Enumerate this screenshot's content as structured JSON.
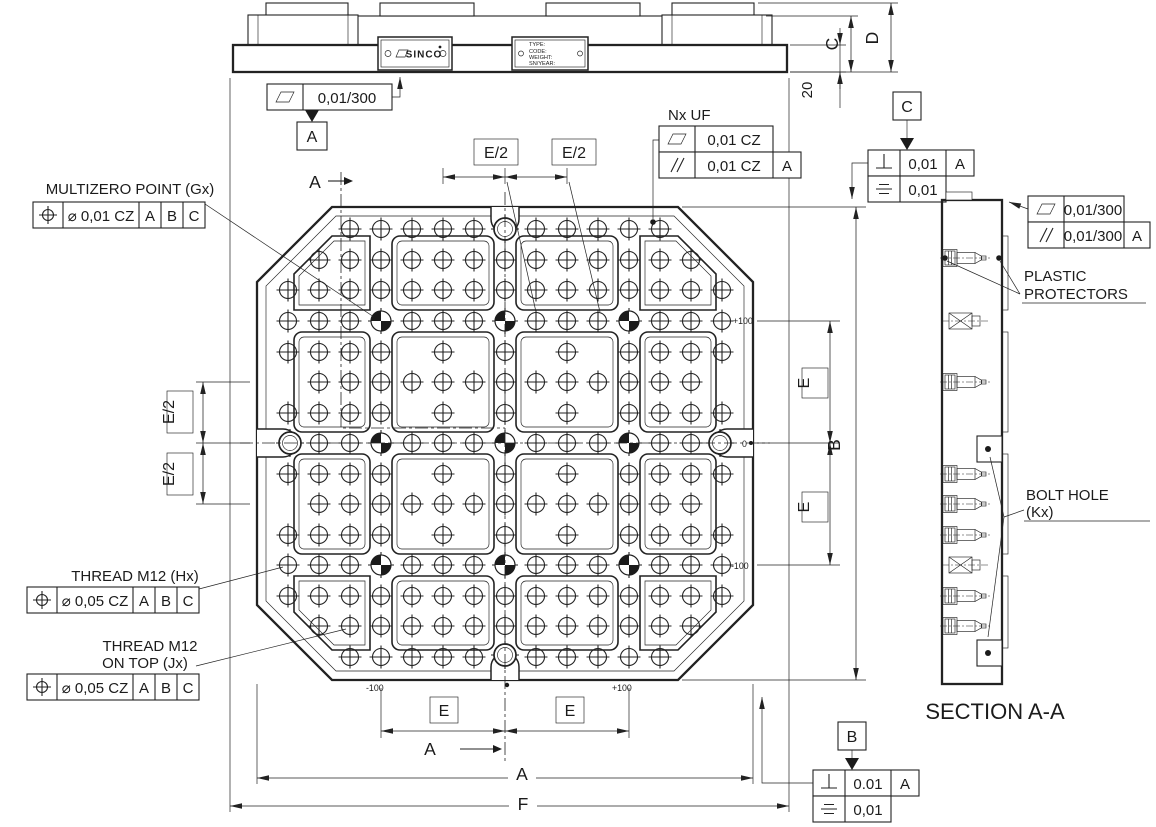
{
  "top_view": {
    "logo": "SINCO",
    "nameplate": {
      "l1": "TYPE:",
      "l2": "CODE:",
      "l3": "WEIGHT:",
      "l4": "SN/YEAR:"
    },
    "flatness": {
      "value": "0,01/300",
      "datum": "A"
    },
    "dims": {
      "c": "C",
      "d": "D",
      "base_thickness": "20"
    }
  },
  "plan": {
    "section_cut": {
      "top": "A",
      "bottom": "A"
    },
    "dims": {
      "e2_top_1": "E/2",
      "e2_top_2": "E/2",
      "e2_left_1": "E/2",
      "e2_left_2": "E/2",
      "e_right_1": "E",
      "e_right_2": "E",
      "b": "B",
      "e_bottom_1": "E",
      "e_bottom_2": "E",
      "a": "A",
      "f": "F"
    },
    "coords": {
      "right_top": "+100",
      "right_mid": "0",
      "right_bottom": "-100",
      "bottom_left": "-100",
      "bottom_right": "+100"
    },
    "multizero": {
      "title": "MULTIZERO POINT (Gx)",
      "tol": "⌀  0,01 CZ",
      "d1": "A",
      "d2": "B",
      "d3": "C"
    },
    "thread_h": {
      "title": "THREAD M12 (Hx)",
      "tol": "⌀  0,05 CZ",
      "d1": "A",
      "d2": "B",
      "d3": "C"
    },
    "thread_j": {
      "title1": "THREAD M12",
      "title2": "ON TOP (Jx)",
      "tol": "⌀  0,05 CZ",
      "d1": "A",
      "d2": "B",
      "d3": "C"
    },
    "nx_uf": {
      "title": "Nx UF",
      "flatness": "0,01 CZ",
      "parallelism": "0,01 CZ",
      "datum": "A"
    },
    "datum_c": {
      "label": "C",
      "perp": "0,01",
      "perp_datum": "A",
      "sym": "0,01"
    },
    "datum_b": {
      "label": "B",
      "perp": "0.01",
      "perp_datum": "A",
      "sym": "0,01"
    }
  },
  "section": {
    "title": "SECTION A-A",
    "flatness": "0,01/300",
    "parallelism": "0,01/300",
    "parallelism_datum": "A",
    "plastic1": "PLASTIC",
    "plastic2": "PROTECTORS",
    "bolt1": "BOLT HOLE",
    "bolt2": "(Kx)"
  }
}
